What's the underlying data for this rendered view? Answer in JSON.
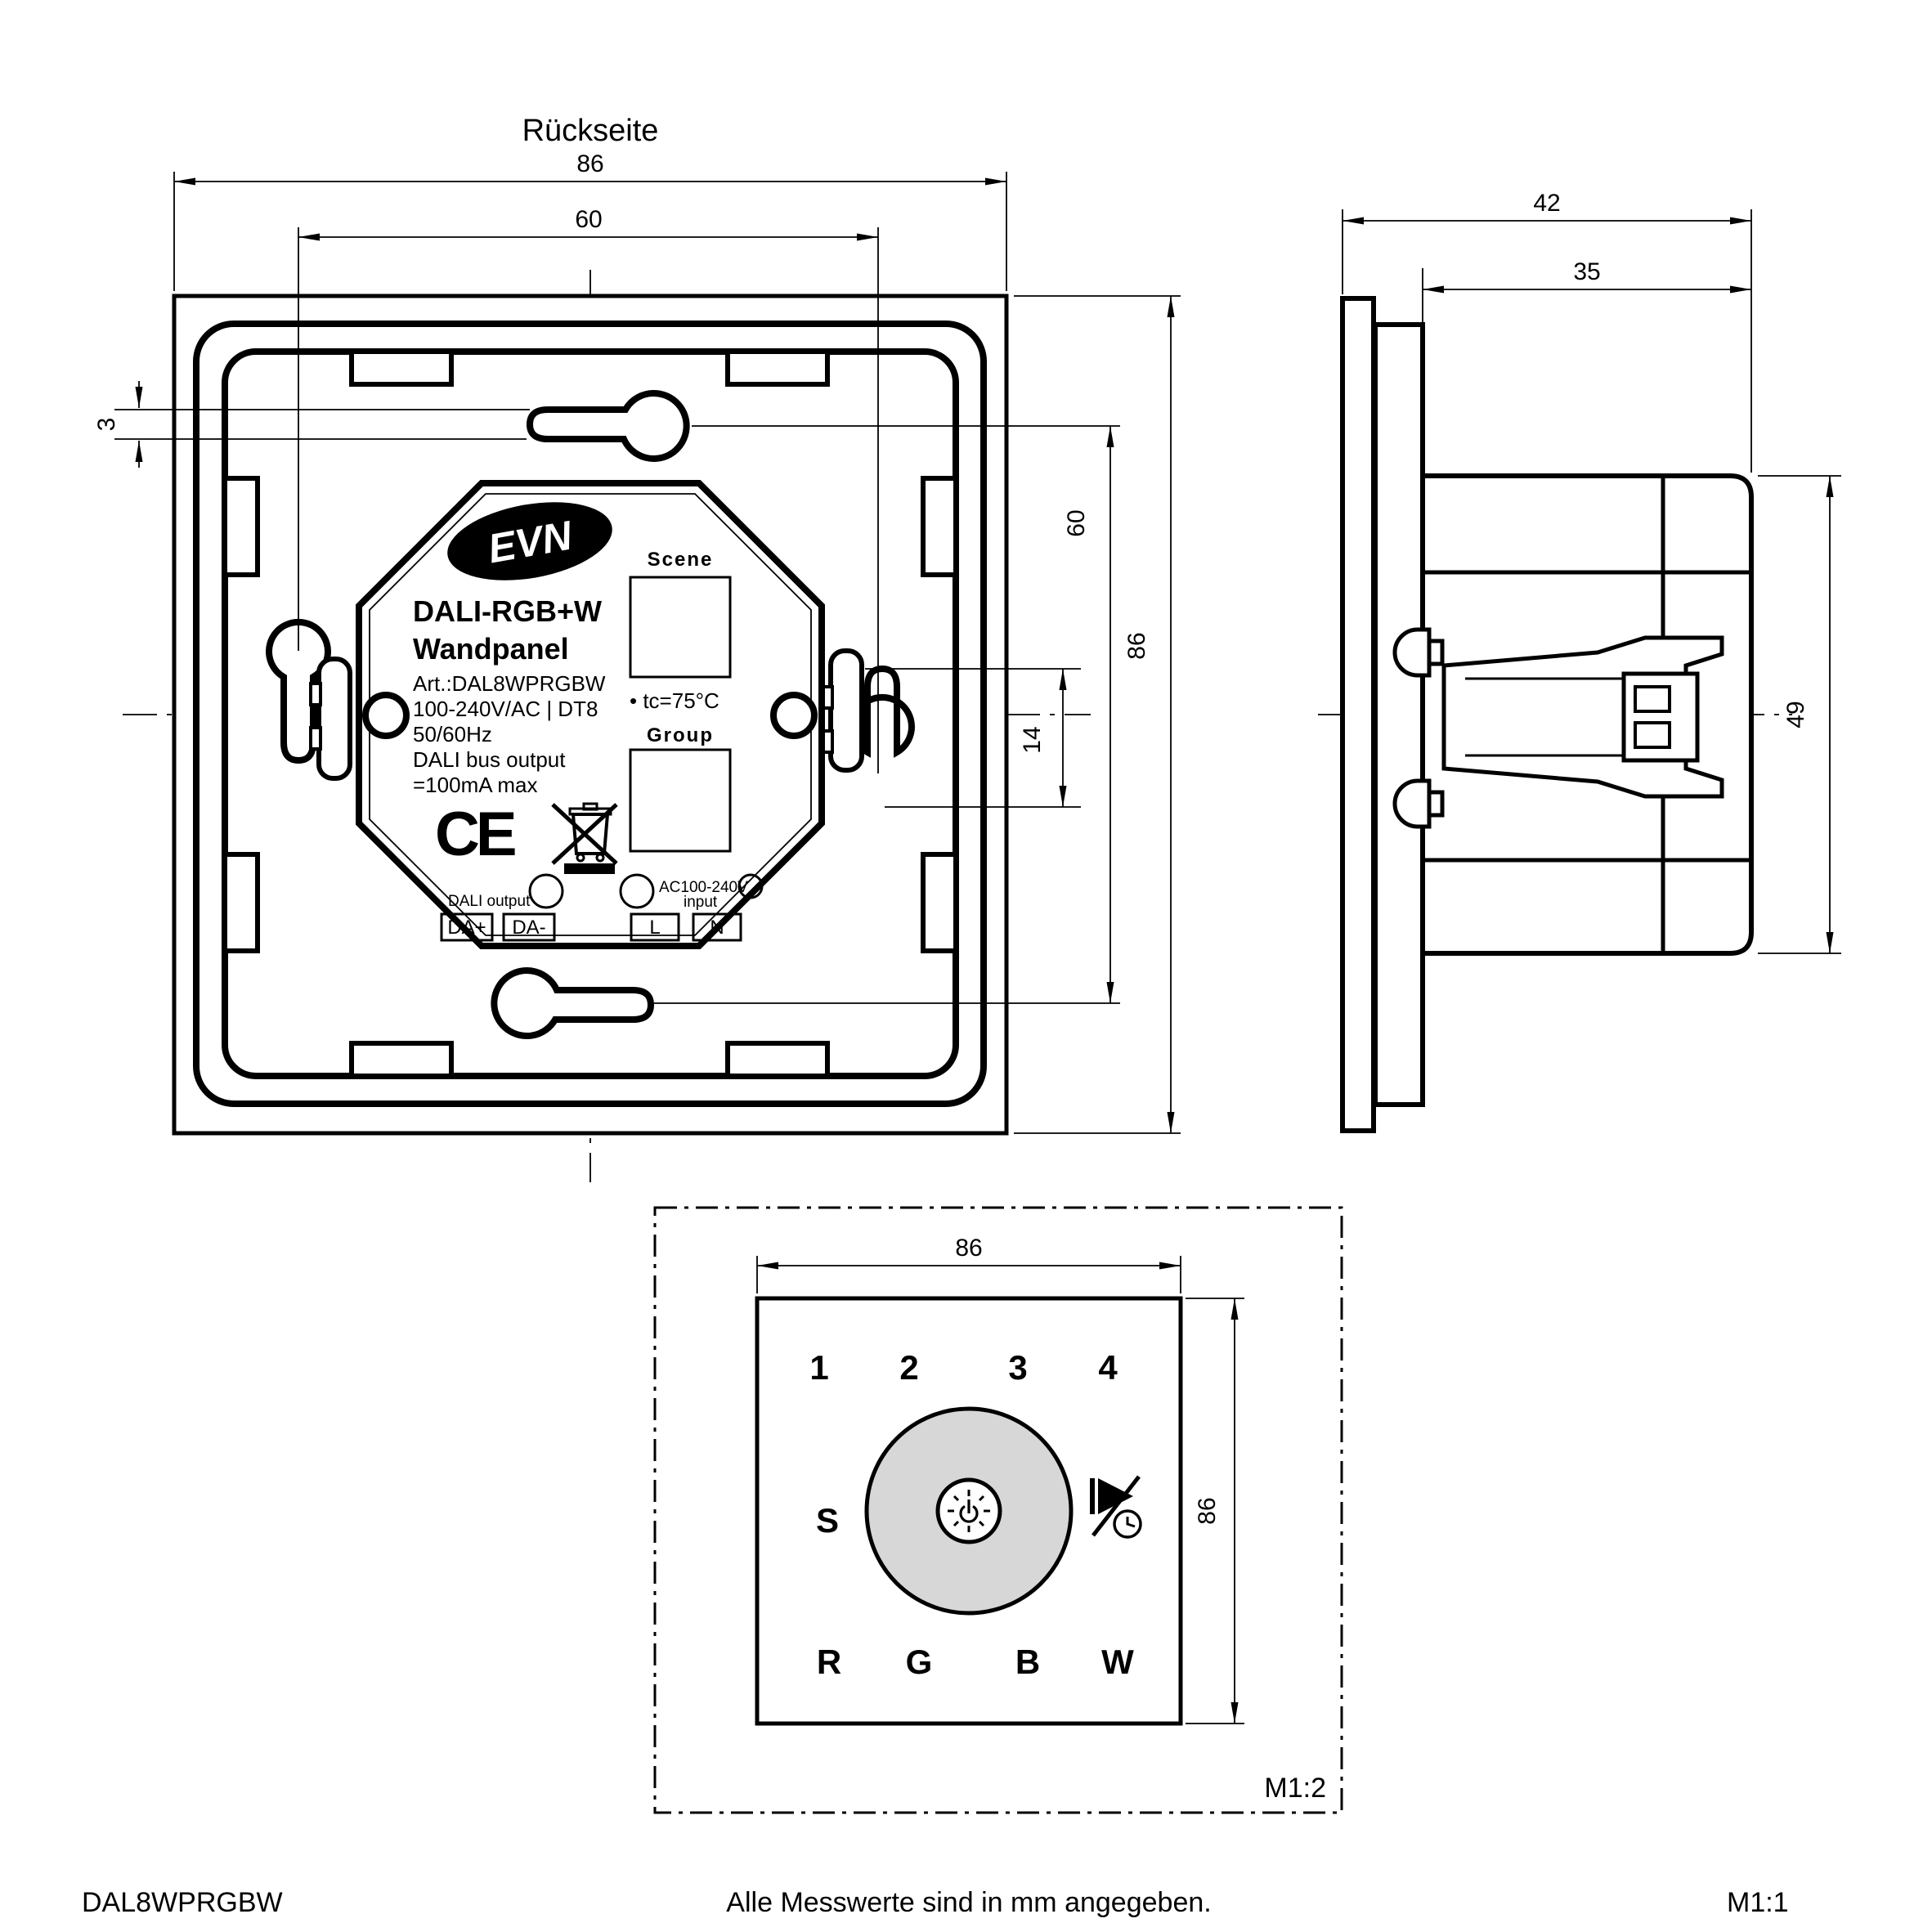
{
  "title": "Rückseite",
  "colors": {
    "line": "#000000",
    "background": "#ffffff",
    "dial_fill": "#d7d7d7"
  },
  "back_view": {
    "dims": {
      "overall_width": "86",
      "mount_spacing_h": "60",
      "slot_height": "3",
      "mount_spacing_v": "60",
      "overall_height": "86",
      "keyhole_length": "14"
    },
    "label": {
      "brand": "EVN",
      "product_line1": "DALI-RGB+W",
      "product_line2": "Wandpanel",
      "spec_lines": [
        "Art.:DAL8WPRGBW",
        "100-240V/AC | DT8",
        "50/60Hz",
        "DALI bus output",
        "=100mA max"
      ],
      "ce_mark": "CE",
      "scene_label": "Scene",
      "tc_note": "• tc=75°C",
      "group_label": "Group",
      "dali_output_label": "DALI output",
      "ac_input_line1": "AC100-240V",
      "ac_input_line2": "input",
      "terminals": [
        "DA+",
        "DA-",
        "L",
        "N"
      ]
    }
  },
  "side_view": {
    "dims": {
      "total_depth": "42",
      "box_depth": "35",
      "body_height": "49"
    }
  },
  "front_view": {
    "dims": {
      "width": "86",
      "height": "86"
    },
    "scale_label": "M1:2",
    "scene_buttons": [
      "1",
      "2",
      "3",
      "4"
    ],
    "s_button": "S",
    "color_buttons": [
      "R",
      "G",
      "B",
      "W"
    ]
  },
  "footer": {
    "article_number": "DAL8WPRGBW",
    "note": "Alle Messwerte sind in mm angegeben.",
    "scale": "M1:1"
  }
}
